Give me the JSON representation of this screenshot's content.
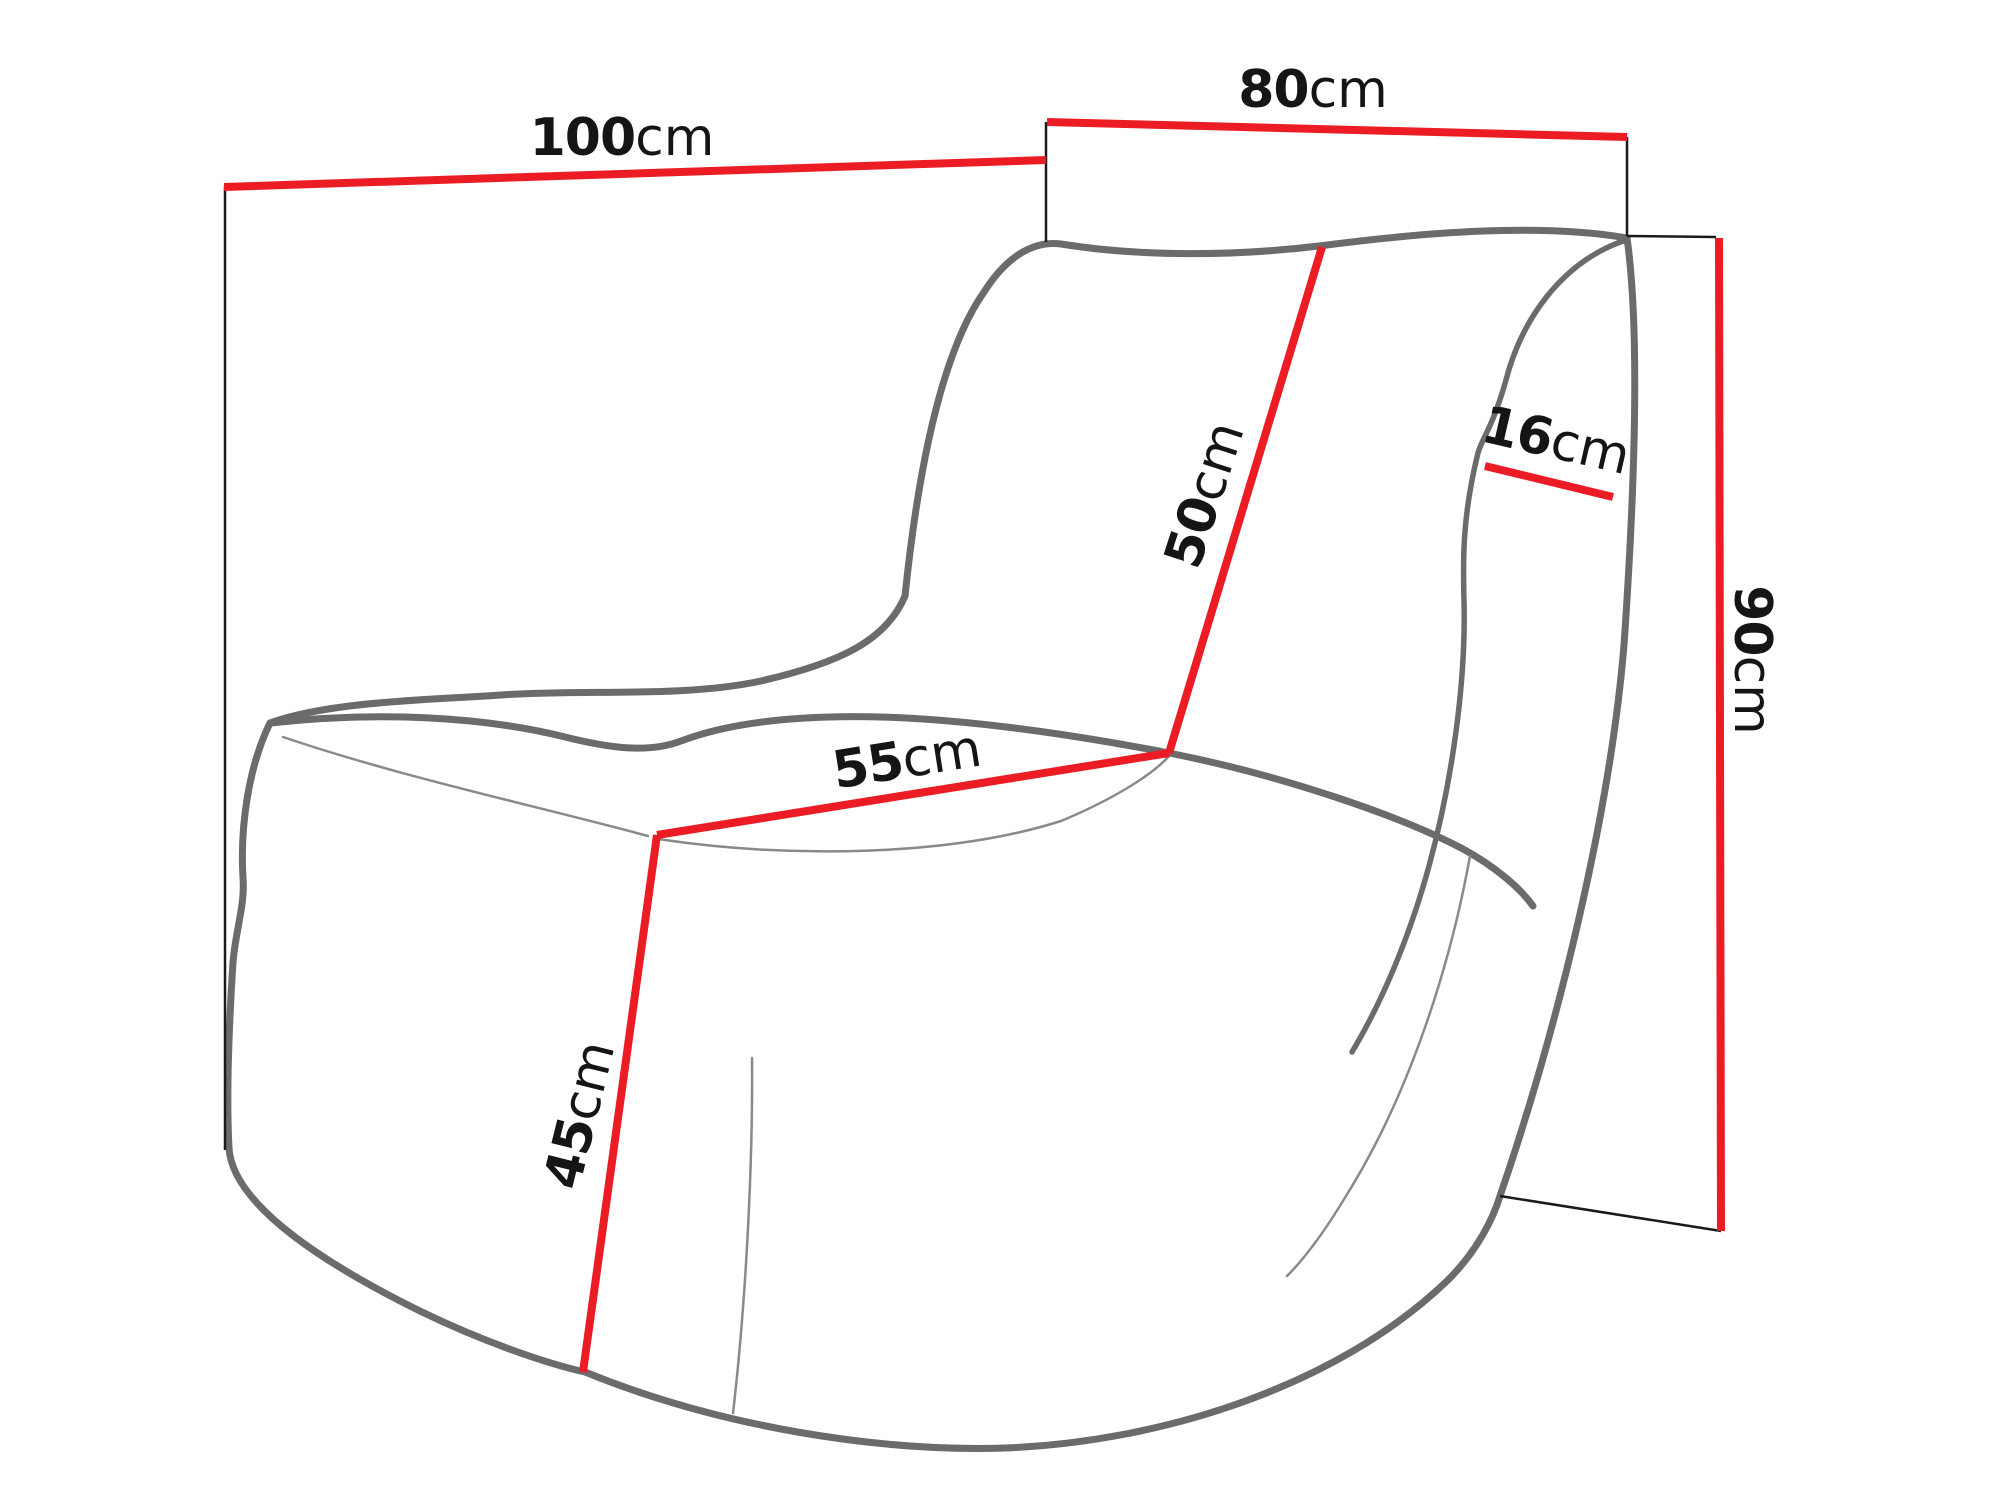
{
  "diagram": {
    "type": "furniture-dimension-diagram",
    "subject": "bean-bag lounge chair line drawing with dimension lines",
    "unit": "cm",
    "dimensions": [
      {
        "id": "back-width",
        "value": "100",
        "unit": "cm"
      },
      {
        "id": "top-depth",
        "value": "80",
        "unit": "cm"
      },
      {
        "id": "overall-height",
        "value": "90",
        "unit": "cm"
      },
      {
        "id": "backrest-length",
        "value": "50",
        "unit": "cm"
      },
      {
        "id": "seat-depth",
        "value": "55",
        "unit": "cm"
      },
      {
        "id": "seat-front-height",
        "value": "45",
        "unit": "cm"
      },
      {
        "id": "backrest-thickness",
        "value": "16",
        "unit": "cm"
      }
    ],
    "colors": {
      "dimension_line": "#ec1c24",
      "extension_line": "#1a1a1a",
      "chair_outline": "#6b6b6b",
      "chair_crease": "#8a8a8a",
      "label_text": "#151515",
      "background": "#ffffff"
    }
  }
}
